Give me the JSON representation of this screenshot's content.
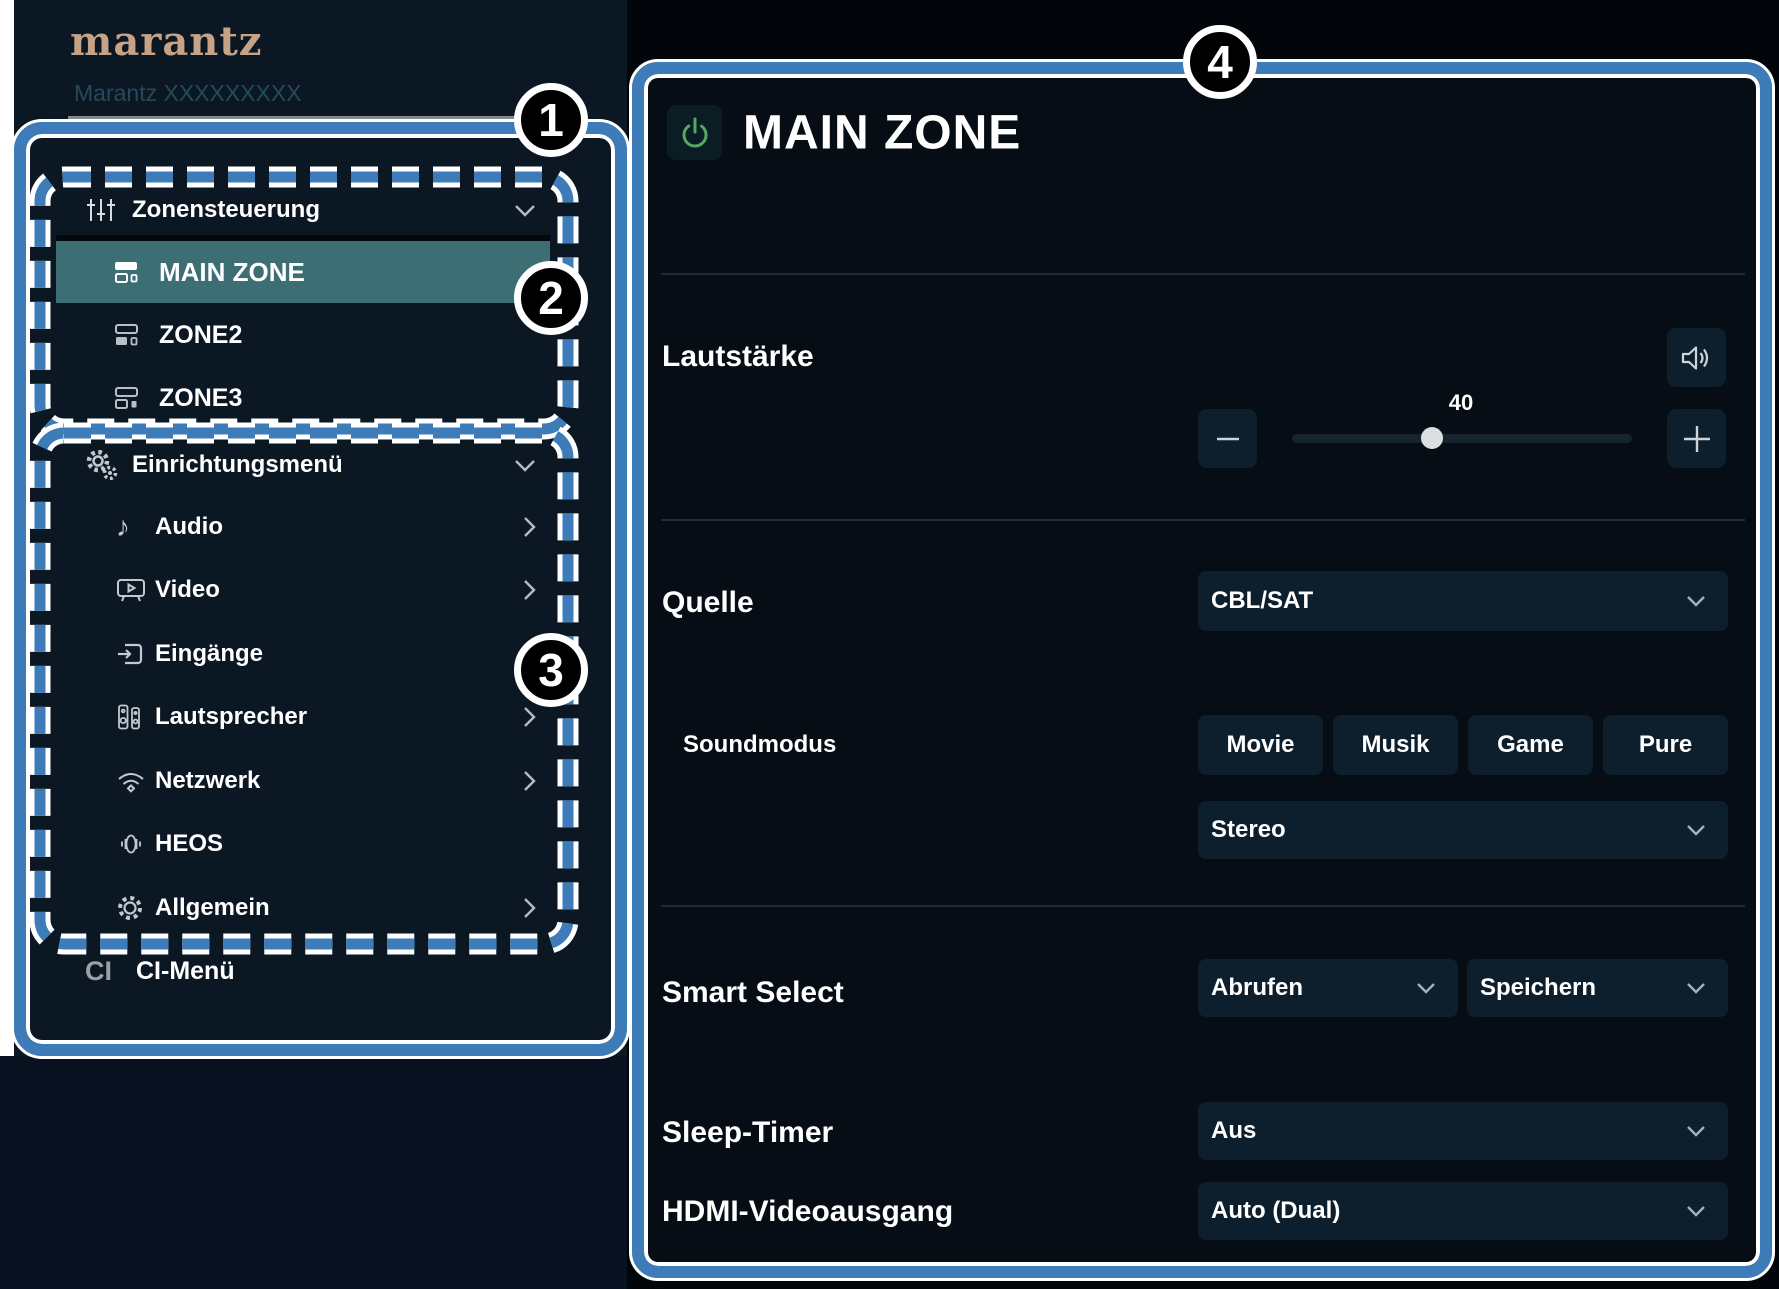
{
  "brand": {
    "logo": "marantz",
    "model": "Marantz XXXXXXXXX"
  },
  "colors": {
    "callout_blue": "#3d7cb8",
    "selected_teal": "#3c6e74",
    "power_green": "#57a75f",
    "panel_bg": "#060d15",
    "sidebar_bg": "#0b1824",
    "control_bg": "#0d1f2d"
  },
  "callouts": {
    "one": "1",
    "two": "2",
    "three": "3",
    "four": "4"
  },
  "sidebar": {
    "zones": {
      "title": "Zonensteuerung",
      "items": [
        {
          "label": "MAIN ZONE",
          "selected": true
        },
        {
          "label": "ZONE2",
          "selected": false
        },
        {
          "label": "ZONE3",
          "selected": false
        }
      ]
    },
    "setup": {
      "title": "Einrichtungsmenü",
      "items": [
        {
          "label": "Audio"
        },
        {
          "label": "Video"
        },
        {
          "label": "Eingänge"
        },
        {
          "label": "Lautsprecher"
        },
        {
          "label": "Netzwerk"
        },
        {
          "label": "HEOS"
        },
        {
          "label": "Allgemein"
        }
      ]
    },
    "ci_badge": "CI",
    "ci_label": "CI-Menü"
  },
  "main": {
    "title": "MAIN ZONE",
    "volume_label": "Lautstärke",
    "volume_value": "40",
    "source_label": "Quelle",
    "source_value": "CBL/SAT",
    "soundmode_label": "Soundmodus",
    "soundmode_buttons": [
      "Movie",
      "Musik",
      "Game",
      "Pure"
    ],
    "soundmode_value": "Stereo",
    "smart_label": "Smart Select",
    "smart_recall": "Abrufen",
    "smart_store": "Speichern",
    "sleep_label": "Sleep-Timer",
    "sleep_value": "Aus",
    "hdmi_label": "HDMI-Videoausgang",
    "hdmi_value": "Auto (Dual)"
  }
}
